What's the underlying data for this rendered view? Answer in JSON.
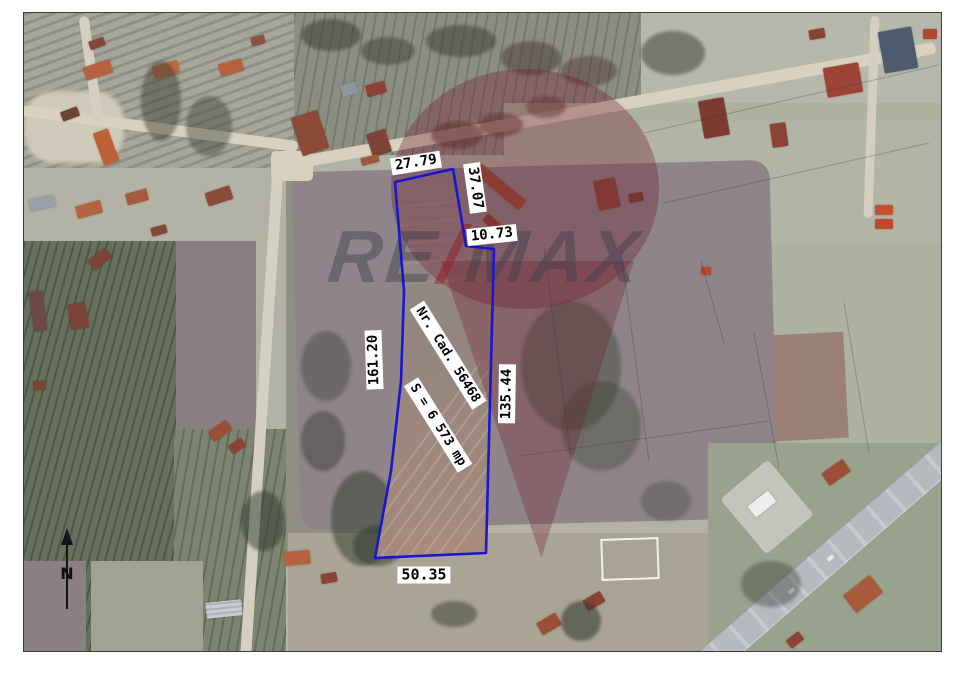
{
  "map": {
    "parcel": {
      "cadastral_label": "Nr. Cad. 56468",
      "area_label": "S = 6 573 mp",
      "side_lengths": {
        "top": "27.79",
        "upper_right": "37.07",
        "notch": "10.73",
        "left": "161.20",
        "right": "135.44",
        "bottom": "50.35"
      },
      "outline_color": "#1a16d0",
      "label_background": "#ffffff"
    },
    "north_indicator": "N",
    "watermark": {
      "part1": "RE",
      "slash": "/",
      "part2": "MAX"
    }
  }
}
